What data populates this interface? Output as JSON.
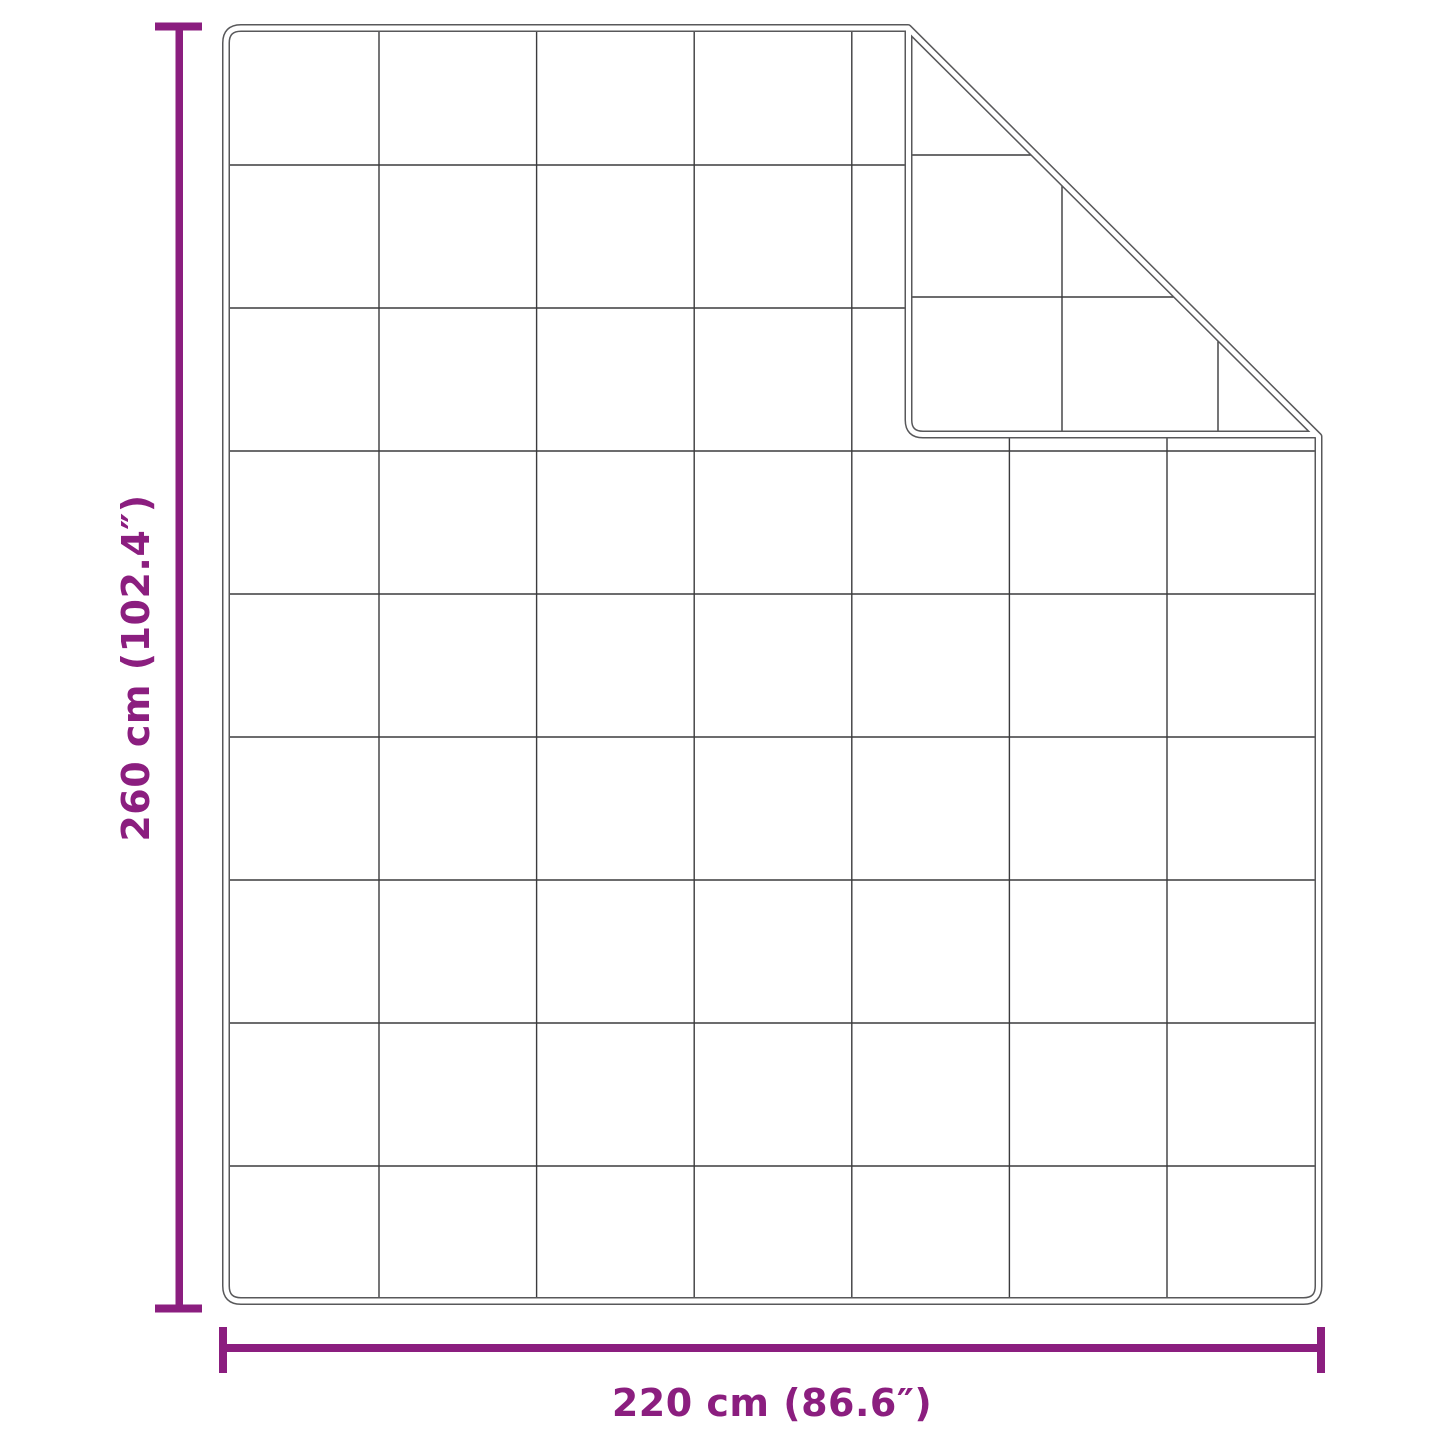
{
  "diagram": {
    "height_dimension": {
      "label": "260 cm (102.4″)",
      "value_cm": 260,
      "value_inches": 102.4
    },
    "width_dimension": {
      "label": "220 cm (86.6″)",
      "value_cm": 220,
      "value_inches": 86.6
    },
    "quilt_grid": {
      "columns": 7,
      "rows": 9
    },
    "colors": {
      "accent": "#8B1E7F",
      "outline": "#58585A",
      "grid_line": "#3B3B3D",
      "background": "#FFFFFF"
    }
  }
}
